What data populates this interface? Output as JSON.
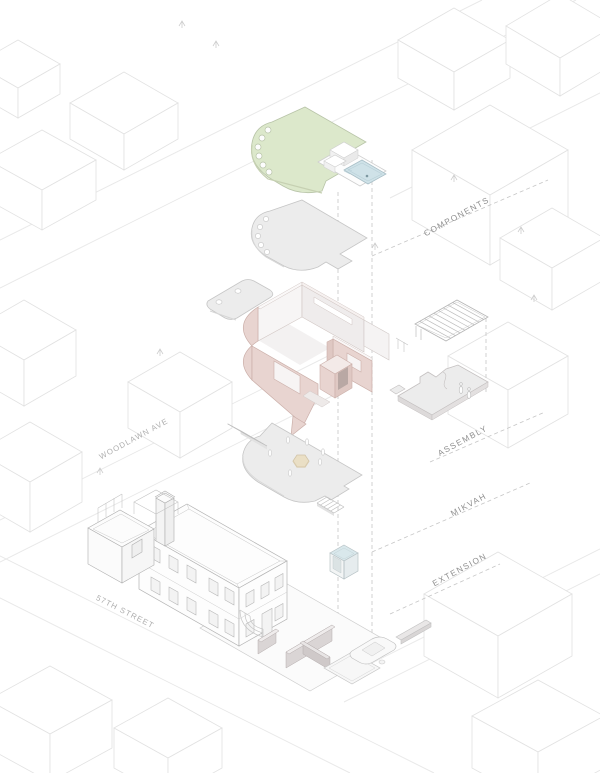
{
  "labels": {
    "components": "COMPONENTS",
    "assembly": "ASSEMBLY",
    "mikvah": "MIKVAH",
    "extension": "EXTENSION",
    "woodlawn_ave": "WOODLAWN AVE",
    "street_57th": "57TH STREET"
  },
  "colors": {
    "roof_green": "#dce8cb",
    "pool_blue": "#cfe2e8",
    "wall_pink": "#e8d4d0",
    "wall_pink_dark": "#dfc8c3",
    "cube_blue_top": "#d9e8ec",
    "hexagon_beige": "#eadfc5",
    "plate_gray": "#ececec",
    "label_gray": "#8f8f8f",
    "street_label_gray": "#aeaeae"
  }
}
